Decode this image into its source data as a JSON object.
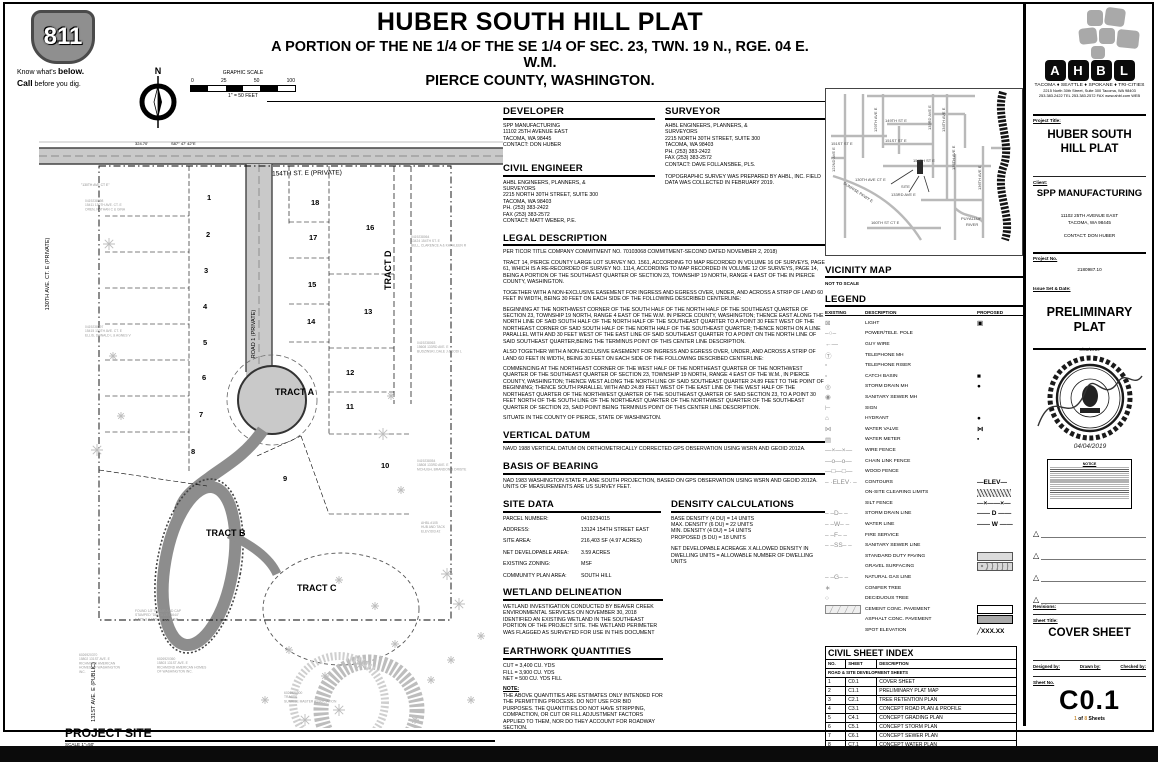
{
  "header": {
    "title": "HUBER SOUTH HILL PLAT",
    "subtitle_line1": "A PORTION OF THE NE 1/4 OF THE SE 1/4 OF SEC. 23, TWN. 19 N., RGE. 04 E. W.M.",
    "subtitle_line2": "PIERCE COUNTY, WASHINGTON."
  },
  "call811": {
    "number": "811",
    "tagline1_pre": "Know what's ",
    "tagline1_bold": "below.",
    "tagline2_bold": "Call",
    "tagline2_post": " before you dig."
  },
  "north_arrow": {
    "label": "N"
  },
  "graphic_scale": {
    "title": "GRAPHIC SCALE",
    "ticks": [
      "0",
      "25",
      "50",
      "100"
    ],
    "note": "1\" = 50 FEET"
  },
  "site_plan": {
    "bearing": "S87° 47' 42\"E",
    "distance": "324.70'",
    "street_top": "154TH ST. E (PRIVATE)",
    "road1": "ROAD 1 (PRIVATE)",
    "street_left": "130TH AVE. CT. E (PRIVATE)",
    "street_left_note": "\"130TH AVE CT E\"",
    "street_bottom": "131ST AVE. E (PUBLIC)",
    "lots": [
      {
        "n": "1",
        "x": 168,
        "y": 96
      },
      {
        "n": "2",
        "x": 167,
        "y": 133
      },
      {
        "n": "3",
        "x": 165,
        "y": 169
      },
      {
        "n": "4",
        "x": 164,
        "y": 205
      },
      {
        "n": "5",
        "x": 164,
        "y": 241
      },
      {
        "n": "6",
        "x": 163,
        "y": 276
      },
      {
        "n": "7",
        "x": 160,
        "y": 313
      },
      {
        "n": "8",
        "x": 152,
        "y": 350
      },
      {
        "n": "9",
        "x": 244,
        "y": 377
      },
      {
        "n": "10",
        "x": 342,
        "y": 364
      },
      {
        "n": "11",
        "x": 307,
        "y": 305
      },
      {
        "n": "12",
        "x": 307,
        "y": 271
      },
      {
        "n": "13",
        "x": 325,
        "y": 210
      },
      {
        "n": "14",
        "x": 268,
        "y": 220
      },
      {
        "n": "15",
        "x": 269,
        "y": 183
      },
      {
        "n": "16",
        "x": 327,
        "y": 126
      },
      {
        "n": "17",
        "x": 270,
        "y": 136
      },
      {
        "n": "18",
        "x": 272,
        "y": 101
      }
    ],
    "tracts": [
      {
        "name": "TRACT A",
        "x": 236,
        "y": 291,
        "rot": 0
      },
      {
        "name": "TRACT B",
        "x": 167,
        "y": 432,
        "rot": 0
      },
      {
        "name": "TRACT C",
        "x": 258,
        "y": 487,
        "rot": 0
      },
      {
        "name": "TRACT D",
        "x": 352,
        "y": 186,
        "rot": -90
      }
    ],
    "annotations": [
      {
        "text": "0419238098\n15411 130TH AVE. CT. E\nOREN, NATHAN C & GINA",
        "x": 46,
        "y": 98
      },
      {
        "text": "0419238097\n15415 130TH AVE. CT. E\nELLIS, DONALD L & AGNES V",
        "x": 46,
        "y": 224
      },
      {
        "text": "0419238064\n13424 154TH ST. E\nBELL, CLARENCE A & KATHLEEN R",
        "x": 372,
        "y": 134
      },
      {
        "text": "0419238063\n15608 133RD AVE. E\nBUDZINSKI, DALE J & JODI L",
        "x": 378,
        "y": 240
      },
      {
        "text": "0419238054\n15808 133RD AVE. E\nMCHUGH, BRANDON & DRISTE",
        "x": 378,
        "y": 358
      },
      {
        "text": "AHBL #105\nHUB AND TACK\nELEV:603.42",
        "x": 382,
        "y": 420
      },
      {
        "text": "FOUND 1/2\" REBAR AND CAP\nSTAMPED \"DELTA LS 44644\"\n1.52'E & 0.15'S OF CORNER",
        "x": 96,
        "y": 508
      },
      {
        "text": "6026920370\n15802 131ST AVE. E\nRICHMOND AMERICAN\nHOMES OF WASHINGTON\nINC.",
        "x": 40,
        "y": 552
      },
      {
        "text": "6026920360\n15803 131ST AVE. E\nRICHMOND AMERICAN HOMES\nOF WASHINGTON INC.",
        "x": 118,
        "y": 556
      },
      {
        "text": "6026920500\nTRACTS\nSUNRISE MASTER ASSOCIATION",
        "x": 245,
        "y": 590
      }
    ],
    "footer": {
      "title": "PROJECT SITE",
      "scale": "SCALE 1\"=50'"
    }
  },
  "sections": {
    "developer": {
      "title": "DEVELOPER",
      "lines": [
        "SPP MANUFACTURING",
        "11102 25TH AVENUE EAST",
        "TACOMA, WA 98445",
        "CONTACT: DON HUBER"
      ]
    },
    "civil_engineer": {
      "title": "CIVIL ENGINEER",
      "lines": [
        "AHBL ENGINEERS, PLANNERS, &",
        "SURVEYORS",
        "2215 NORTH 30TH STREET, SUITE 300",
        "TACOMA, WA  98403",
        "PH. (253) 383-2422",
        "FAX (253) 383-2572",
        "CONTACT: MATT WEBER, P.E."
      ]
    },
    "surveyor": {
      "title": "SURVEYOR",
      "lines": [
        "AHBL ENGINEERS, PLANNERS, &",
        "SURVEYORS",
        "2215 NORTH 30TH STREET, SUITE 300",
        "TACOMA, WA  98403",
        "PH. (253) 383-2422",
        "FAX (253) 383-2572",
        "CONTACT: DAVE FOLLANSBEE, PLS."
      ],
      "note": "TOPOGRAPHIC SURVEY WAS PREPARED BY AHBL, INC. FIELD DATA WAS COLLECTED IN FEBRUARY 2019."
    },
    "legal_description": {
      "title": "LEGAL DESCRIPTION",
      "paragraphs": [
        "PER TICOR TITLE COMPANY COMMITMENT NO. 70103068 COMMITMENT-SECOND  DATED NOVEMBER 2, 2018)",
        "TRACT 14, PIERCE COUNTY LARGE LOT SURVEY NO. 1561, ACCORDING TO MAP RECORDED IN VOLUME 16 OF SURVEYS, PAGE 61, WHICH IS A RE-RECORDED OF SURVEY NO. 1114, ACCORDING TO MAP RECORDED IN VOLUME 12 OF SURVEYS, PAGE 14, BEING A PORTION OF THE SOUTHEAST QUARTER OF SECTION 23, TOWNSHIP 19 NORTH, RANGE 4 EAST OF THE IN PIERCE COUNTY, WASHINGTON.",
        "TOGETHER WITH A NON-EXCLUSIVE EASEMENT FOR INGRESS AND EGRESS OVER, UNDER, AND ACROSS A STRIP OF LAND 60 FEET IN WIDTH, BEING 30 FEET ON EACH SIDE OF THE FOLLOWING DESCRIBED CENTERLINE:",
        "BEGINNING AT THE NORTHWEST CORNER OF THE SOUTH HALF OF THE NORTH HALF OF THE SOUTHEAST QUARTER OF SECTION 23, TOWNSHIP 19 NORTH, RANGE 4 EAST OF THE W.M. IN PIERCE COUNTY, WASHINGTON; THENCE EAST ALONG THE NORTH LINE OF SAID SOUTH HALF OF THE NORTH HALF OF THE SOUTHEAST QUARTER TO A POINT 30 FEET WEST OF THE NORTHEAST CORNER OF SAID SOUTH HALF OF THE NORTH HALF OF THE SOUTHEAST QUARTER; THENCE NORTH ON A LINE PARALLEL WITH AND 30 FEET WEST OF THE EAST LINE OF SAID SOUTHEAST QUARTER TO A POINT ON THE NORTH LINE OF SAID SOUTHEAST QUARTER,BEING THE TERMINUS POINT OF THIS CENTER LINE DESCRIPTION.",
        "ALSO TOGETHER WITH A NON-EXCLUSIVE EASEMENT FOR INGRESS AND EGRESS OVER, UNDER, AND ACROSS A STRIP OF LAND 60 FEET IN WIDTH, BEING 30 FEET ON EACH SIDE OF THE FOLLOWING DESCRIBED CENTERLINE:",
        "COMMENCING AT THE NORTHEAST CORNER OF THE WEST HALF OF THE NORTHEAST QUARTER OF THE NORTHWEST QUARTER OF THE SOUTHEAST QUARTER OF SECTION 23, TOWNSHIP 19 NORTH, RANGE 4 EAST OF THE W.M., IN PIERCE COUNTY, WASHINGTON; THENCE WEST ALONG THE NORTH LINE OF SAID SOUTHEAST QUARTER 24.89 FEET TO THE POINT OF BEGINNING; THENCE SOUTH PARALLEL WITH AND 24.89 FEET WEST OF THE EAST LINE OF THE WEST HALF OF THE NORTHEAST QUARTER OF THE NORTHWEST QUARTER OF THE SOUTHEAST QUARTER OF SAID SECTION 23, TO A POINT 30 FEET NORTH OF THE SOUTH LINE OF THE NORTHEAST QUARTER OF THE NORTHWEST QUARTER OF THE SOUTHEAST QUARTER OF SECTION 23, SAID POINT BEING TERMINUS POINT OF THIS CENTER LINE DESCRIPTION.",
        "SITUATE IN THE COUNTY OF PIERCE, STATE OF WASHINGTON."
      ]
    },
    "vertical_datum": {
      "title": "VERTICAL DATUM",
      "body": "NAVD 1988 VERTICAL DATUM ON ORTHOMETRICALLY CORRECTED GPS OBSERVATION USING WSRN AND GEOID 2012A."
    },
    "basis_of_bearing": {
      "title": "BASIS OF BEARING",
      "body": "NAD 1983  WASHINGTON STATE PLANE SOUTH PROJECTION, BASED ON GPS OBSERVATION USING WSRN AND GEOID 2012A. UNITS OF MEASUREMENTS ARE US SURVEY FEET."
    },
    "site_data": {
      "title": "SITE DATA",
      "rows": [
        {
          "label": "PARCEL NUMBER:",
          "value": "0419234015"
        },
        {
          "label": "ADDRESS:",
          "value": "13124 154TH STREET EAST"
        },
        {
          "label": "SITE AREA:",
          "value": "216,403 SF  (4.97 ACRES)"
        },
        {
          "label": "NET DEVELOPABLE AREA:",
          "value": "3.59 ACRES"
        },
        {
          "label": "EXISTING ZONING:",
          "value": "MSF"
        },
        {
          "label": "COMMUNITY PLAN AREA:",
          "value": "SOUTH HILL"
        }
      ]
    },
    "density_calculations": {
      "title": "DENSITY CALCULATIONS",
      "lines": [
        "BASE DENSITY (4 DU) = 14 UNITS",
        "MAX. DENSITY (6 DU)  = 22 UNITS",
        "MIN. DENSITY (4 DU)  = 14 UNITS",
        "PROPOSED (5 DU)      = 18 UNITS"
      ],
      "note": "NET DEVELOPABLE ACREAGE X ALLOWED DENSITY IN DWELLING UNITS = ALLOWABLE NUMBER OF DWELLING UNITS"
    },
    "wetland_delineation": {
      "title": "WETLAND DELINEATION",
      "body": "WETLAND INVESTIGATION CONDUCTED BY BEAVER CREEK ENVIRONMENTAL SERVICES ON NOVEMBER 30, 2018 IDENTIFIED AN EXISTING WETLAND IN THE SOUTHEAST PORTION OF THE PROJECT SITE.  THE WETLAND PERIMETER WAS FLAGGED AS SURVEYED FOR USE IN THIS DOCUMENT"
    },
    "earthwork_quantities": {
      "title": "EARTHWORK QUANTITIES",
      "lines": [
        "CUT = 3,400 CU. YDS",
        "FILL = 3,900 CU. YDS",
        "NET = 500 CU. YDS FILL"
      ],
      "note_label": "NOTE:",
      "note": "THE ABOVE QUANTITIES ARE ESTIMATES ONLY INTENDED FOR THE PERMITTING PROCESS. DO NOT USE FOR BID PURPOSES. THE QUANTITIES DO NOT HAVE STRIPPING, COMPACTION, OR CUT OR FILL ADJUSTMENT FACTORS APPLIED TO THEM, NOR DO THEY ACCOUNT FOR ROADWAY SECTION."
    }
  },
  "vicinity": {
    "title": "VICINITY MAP",
    "note": "NOT TO SCALE",
    "labels": [
      {
        "t": "151ST ST E",
        "x": 6,
        "y": 57,
        "r": 0
      },
      {
        "t": "129TH AVE E",
        "x": 52,
        "y": 44,
        "r": -90
      },
      {
        "t": "149TH ST E",
        "x": 60,
        "y": 34,
        "r": 0
      },
      {
        "t": "133RD AVE E",
        "x": 106,
        "y": 42,
        "r": -90
      },
      {
        "t": "134TH AVE E",
        "x": 120,
        "y": 44,
        "r": -90
      },
      {
        "t": "151ST ST E",
        "x": 60,
        "y": 54,
        "r": 0
      },
      {
        "t": "154TH ST E",
        "x": 88,
        "y": 74,
        "r": 0
      },
      {
        "t": "135TH AVE E",
        "x": 130,
        "y": 82,
        "r": -90
      },
      {
        "t": "130TH AVE CT E",
        "x": 30,
        "y": 93,
        "r": 0
      },
      {
        "t": "SITE",
        "x": 76,
        "y": 100,
        "r": 0
      },
      {
        "t": "133RD AVE E",
        "x": 66,
        "y": 108,
        "r": 0
      },
      {
        "t": "SUNRISE PKWY E",
        "x": 18,
        "y": 96,
        "r": 33
      },
      {
        "t": "136TH AVE E",
        "x": 156,
        "y": 102,
        "r": -90
      },
      {
        "t": "160TH ST CT E",
        "x": 46,
        "y": 136,
        "r": 0
      },
      {
        "t": "PUYALLUP",
        "x": 136,
        "y": 132,
        "r": 0
      },
      {
        "t": "RIVER",
        "x": 141,
        "y": 138,
        "r": 0
      },
      {
        "t": "122ND AVE E",
        "x": 10,
        "y": 84,
        "r": -90
      }
    ]
  },
  "legend": {
    "title": "LEGEND",
    "col_existing": "EXISTING",
    "col_description": "DESCRIPTION",
    "col_proposed": "PROPOSED",
    "items": [
      {
        "description": "LIGHT",
        "existing": "⊠",
        "proposed": "▣"
      },
      {
        "description": "POWER/TELE. POLE",
        "existing": "–○–",
        "proposed": null
      },
      {
        "description": "GUY WIRE",
        "existing": "←—",
        "proposed": null
      },
      {
        "description": "TELEPHONE MH",
        "existing": "Ⓣ",
        "proposed": null
      },
      {
        "description": "TELEPHONE RISER",
        "existing": "▫",
        "proposed": null
      },
      {
        "description": "CATCH BASIN",
        "existing": "▫",
        "proposed": "■"
      },
      {
        "description": "STORM DRAIN MH",
        "existing": "◎",
        "proposed": "●"
      },
      {
        "description": "SANITARY SEWER MH",
        "existing": "◉",
        "proposed": null
      },
      {
        "description": "SIGN",
        "existing": "⊢",
        "proposed": null
      },
      {
        "description": "HYDRANT",
        "existing": "⌂",
        "proposed": "●"
      },
      {
        "description": "WATER VALVE",
        "existing": "⋈",
        "proposed": "⋈"
      },
      {
        "description": "WATER METER",
        "existing": "▤",
        "proposed": "▪"
      },
      {
        "description": "WIRE FENCE",
        "existing": "—×—×—",
        "proposed": null
      },
      {
        "description": "CHAIN LINK FENCE",
        "existing": "—o—o—",
        "proposed": null
      },
      {
        "description": "WOOD FENCE",
        "existing": "—□—□—",
        "proposed": null
      },
      {
        "description": "CONTOURS",
        "existing": "– ·ELEV· –",
        "proposed": "—ELEV—"
      },
      {
        "description": "ON-SITE CLEARING LIMITS",
        "existing": null,
        "proposed": "swatch:hatch"
      },
      {
        "description": "SILT FENCE",
        "existing": null,
        "proposed": "—×——×—"
      },
      {
        "description": "STORM DRAIN LINE",
        "existing": "– –D– –",
        "proposed": "—— D ——"
      },
      {
        "description": "WATER LINE",
        "existing": "– –W– –",
        "proposed": "—— W ——"
      },
      {
        "description": "FIRE SERVICE",
        "existing": "– –F– –",
        "proposed": null
      },
      {
        "description": "SANITARY SEWER LINE",
        "existing": "– –SS– –",
        "proposed": null
      },
      {
        "description": "STANDARD DUTY PAVING",
        "existing": null,
        "proposed": "swatch:paving"
      },
      {
        "description": "GRAVEL SURFACING",
        "existing": null,
        "proposed": "swatch:gravel"
      },
      {
        "description": "NATURAL GAS LINE",
        "existing": "– –G– –",
        "proposed": null
      },
      {
        "description": "CONIFER TREE",
        "existing": "∗",
        "proposed": null
      },
      {
        "description": "DECIDUOUS TREE",
        "existing": "○",
        "proposed": null
      },
      {
        "description": "CEMENT CONC. PAVEMENT",
        "existing": "swatch:cement",
        "proposed": "swatch:white"
      },
      {
        "description": "ASPHALT CONC. PAVEMENT",
        "existing": null,
        "proposed": "swatch:asphalt"
      },
      {
        "description": "SPOT ELEVATION",
        "existing": null,
        "proposed": "╱XXX.XX"
      }
    ]
  },
  "sheet_index": {
    "title": "CIVIL SHEET INDEX",
    "headers": [
      "NO.",
      "SHEET",
      "DESCRIPTION"
    ],
    "group": "ROAD & SITE DEVELOPMENT SHEETS",
    "rows": [
      [
        "1",
        "C0.1",
        "COVER SHEET"
      ],
      [
        "2",
        "C1.1",
        "PRELIMINARY PLAT MAP"
      ],
      [
        "3",
        "C2.1",
        "TREE RETENTION PLAN"
      ],
      [
        "4",
        "C3.1",
        "CONCEPT ROAD PLAN & PROFILE"
      ],
      [
        "5",
        "C4.1",
        "CONCEPT GRADING PLAN"
      ],
      [
        "6",
        "C5.1",
        "CONCEPT STORM PLAN"
      ],
      [
        "7",
        "C6.1",
        "CONCEPT SEWER PLAN"
      ],
      [
        "8",
        "C7.1",
        "CONCEPT WATER PLAN"
      ]
    ]
  },
  "title_block": {
    "logo_letters": [
      "A",
      "H",
      "B",
      "L"
    ],
    "cities": "TACOMA ♦ SEATTLE ♦ SPOKANE ♦ TRI-CITIES",
    "address_line1": "2215 North 30th Street, Suite 300    Tacoma, WA 98403",
    "address_line2": "253.383.2422 TEL    253.383.2572 FAX    www.ahbl.com WEB",
    "project_title_label": "Project Title:",
    "project_title": "HUBER SOUTH HILL PLAT",
    "client_label": "Client:",
    "client": "SPP MANUFACTURING",
    "client_address1": "11102 25TH AVENUE EAST",
    "client_address2": "TACOMA, WA 98445",
    "client_contact": "CONTACT: DON HUBER",
    "project_no_label": "Project No.",
    "project_no": "2180987.10",
    "issue_label": "Issue Set & Date:",
    "issue_set": "PRELIMINARY PLAT",
    "issue_date": "4/03/2019",
    "stamp_date": "04/04/2019",
    "notice_title": "NOTICE",
    "revisions_label": "Revisions:",
    "sheet_title_label": "Sheet Title:",
    "sheet_title": "COVER SHEET",
    "designed_by_label": "Designed by:",
    "drawn_by_label": "Drawn by:",
    "checked_by_label": "Checked by:",
    "sheet_no_label": "Sheet No.",
    "sheet_no": "C0.1",
    "page_current": "1",
    "page_of": "of",
    "page_total": "8",
    "page_sheets": "Sheets"
  }
}
